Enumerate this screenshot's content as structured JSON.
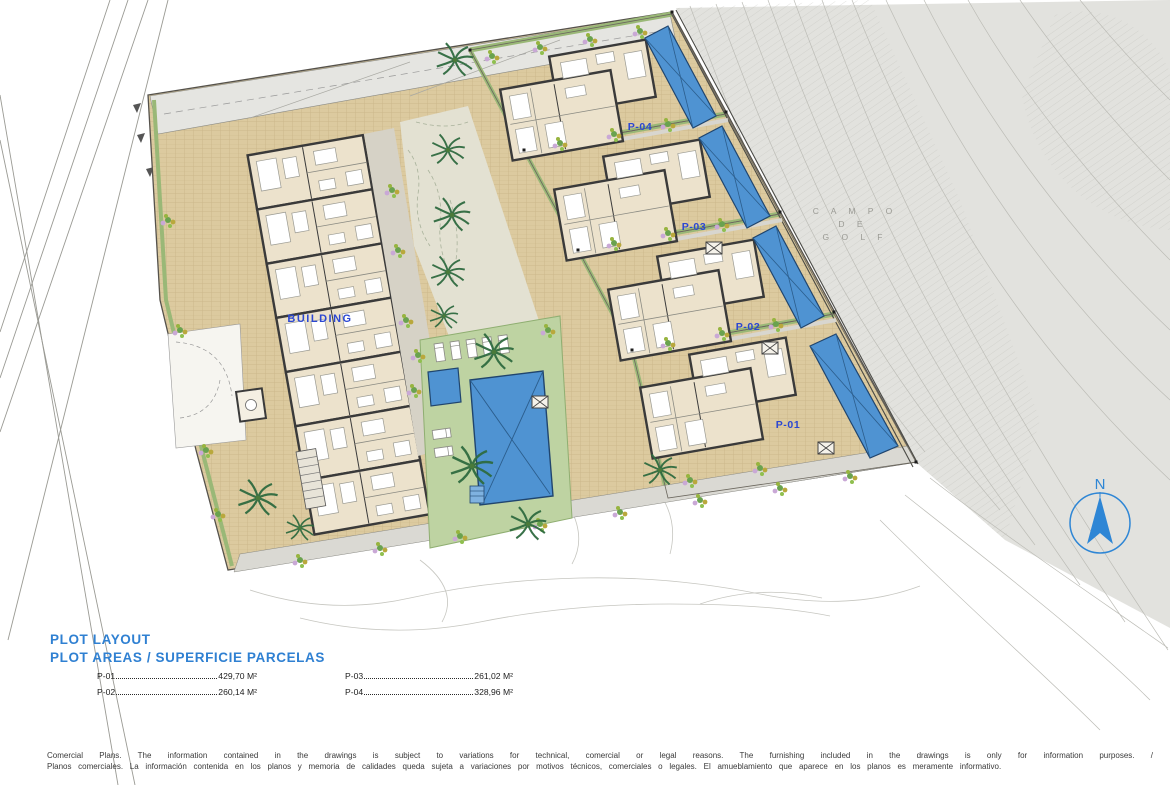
{
  "plan": {
    "building_label": "BUILDING",
    "plot_labels": [
      {
        "id": "P-04"
      },
      {
        "id": "P-03"
      },
      {
        "id": "P-02"
      },
      {
        "id": "P-01"
      }
    ],
    "golf_area_label": {
      "line1": "C A M P O",
      "line2": "D E",
      "line3": "G O L F"
    },
    "north_label": "N"
  },
  "legend": {
    "title": "PLOT LAYOUT",
    "subtitle": "PLOT AREAS / SUPERFICIE PARCELAS",
    "rows": [
      {
        "label": "P-01",
        "value": "429,70 M²"
      },
      {
        "label": "P-02",
        "value": "260,14 M²"
      },
      {
        "label": "P-03",
        "value": "261,02 M²"
      },
      {
        "label": "P-04",
        "value": "328,96 M²"
      }
    ]
  },
  "disclaimer": {
    "line_en": "Comercial Plans. The information contained in the drawings is subject to variations for technical, comercial or legal reasons. The furnishing included in the drawings is only for information purposes. /",
    "line_es": "Planos comerciales. La información contenida en los planos y memoria de calidades queda sujeta a variaciones por motivos técnicos, comerciales o legales. El amueblamiento que aparece en los planos es meramente informativo."
  },
  "colors": {
    "accent_blue": "#2e86d5",
    "label_blue": "#2b47d2",
    "pool_blue": "#4f93d2",
    "lawn_green": "#bed3a2",
    "paving_tan": "#dcca9f",
    "terrain_gray": "#e2e2de"
  }
}
